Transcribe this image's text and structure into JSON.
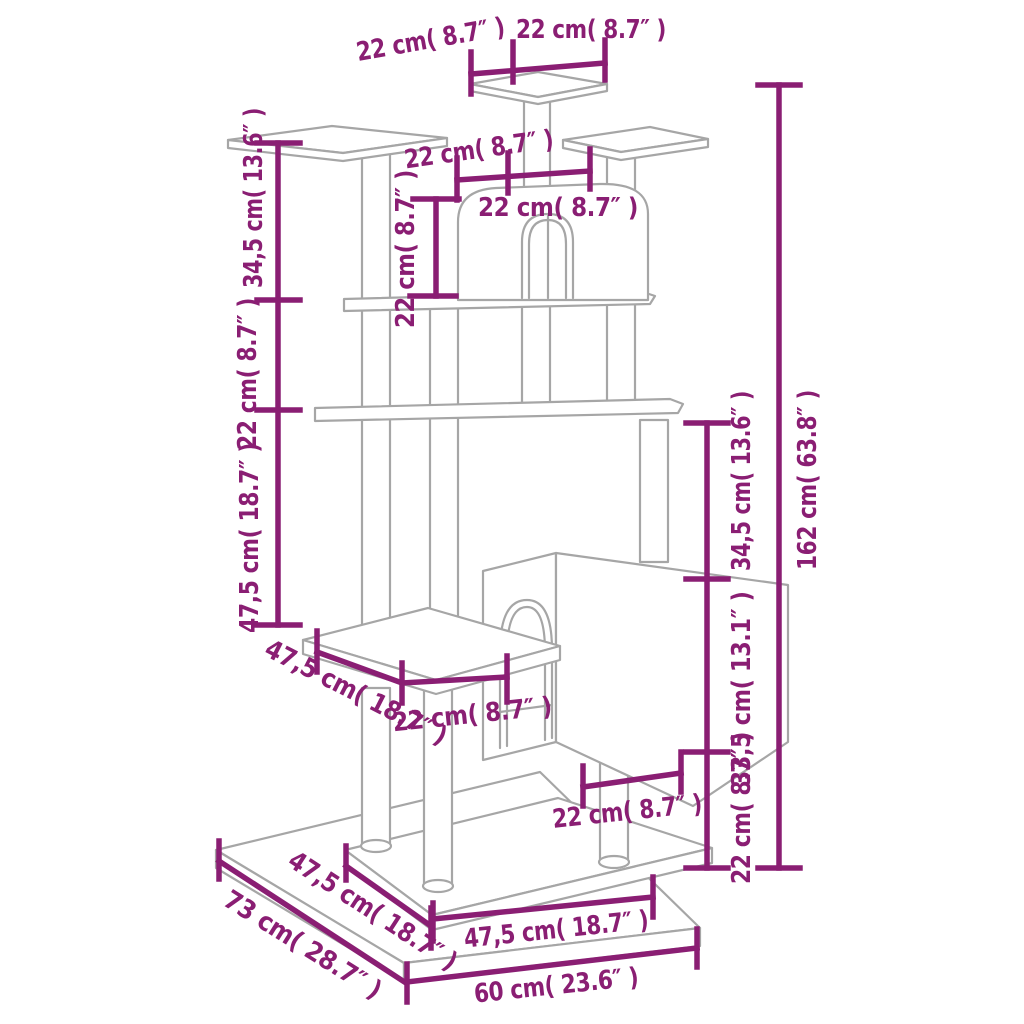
{
  "colors": {
    "dimension_accent": "#8a1e73",
    "artwork_line": "#a6a6a6",
    "background": "#ffffff"
  },
  "diagram": {
    "dimensions": [
      {
        "id": "top-platform-width-left",
        "label": "22 cm( 8.7″ )"
      },
      {
        "id": "top-platform-width-right",
        "label": "22 cm( 8.7″ )"
      },
      {
        "id": "level2-width-left",
        "label": "22 cm( 8.7″ )"
      },
      {
        "id": "level2-width-right",
        "label": "22 cm( 8.7″ )"
      },
      {
        "id": "upper-house-height",
        "label": "22 cm( 8.7″ )"
      },
      {
        "id": "left-height-top",
        "label": "34,5 cm( 13.6″ )"
      },
      {
        "id": "left-height-middle",
        "label": "22 cm( 8.7″ )"
      },
      {
        "id": "left-height-bottom",
        "label": "47,5 cm( 18.7″ )"
      },
      {
        "id": "mid-platform-depth",
        "label": "47,5 cm( 18.7″ )"
      },
      {
        "id": "mid-platform-width",
        "label": "22 cm( 8.7″ )"
      },
      {
        "id": "right-height-top",
        "label": "34,5 cm( 13.6″ )"
      },
      {
        "id": "right-height-middle",
        "label": "33,5 cm( 13.1″ )"
      },
      {
        "id": "right-height-bottom",
        "label": "22 cm( 8.7″ )"
      },
      {
        "id": "total-height",
        "label": "162 cm( 63.8″ )"
      },
      {
        "id": "lower-house-width",
        "label": "22 cm( 8.7″ )"
      },
      {
        "id": "base-depth-total",
        "label": "73 cm( 28.7″ )"
      },
      {
        "id": "base-top-depth",
        "label": "47,5 cm( 18.7″ )"
      },
      {
        "id": "base-top-width",
        "label": "47,5 cm( 18.7″ )"
      },
      {
        "id": "base-width-total",
        "label": "60 cm( 23.6″ )"
      }
    ]
  }
}
